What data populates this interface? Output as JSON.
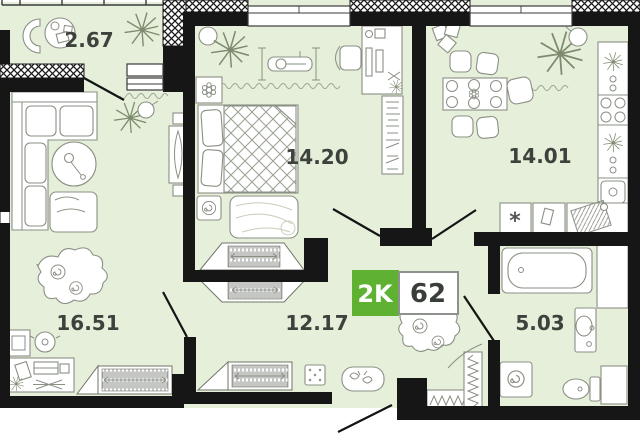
{
  "plan": {
    "rooms": [
      {
        "id": "balcony",
        "area": "2.67"
      },
      {
        "id": "bedroom",
        "area": "14.20"
      },
      {
        "id": "kitchen",
        "area": "14.01"
      },
      {
        "id": "living-room",
        "area": "16.51"
      },
      {
        "id": "hallway",
        "area": "12.17"
      },
      {
        "id": "bathroom",
        "area": "5.03"
      }
    ],
    "badge": {
      "type_label": "2K",
      "total_area": "62"
    },
    "symbols": {
      "fridge_asterisk": "*"
    },
    "colors": {
      "floor": "#e5efda",
      "walls": "#161616",
      "badge_green": "#5fb132",
      "badge_border": "#8d938c",
      "label_text": "#3d423c",
      "furniture_stroke": "#8a9084"
    }
  }
}
